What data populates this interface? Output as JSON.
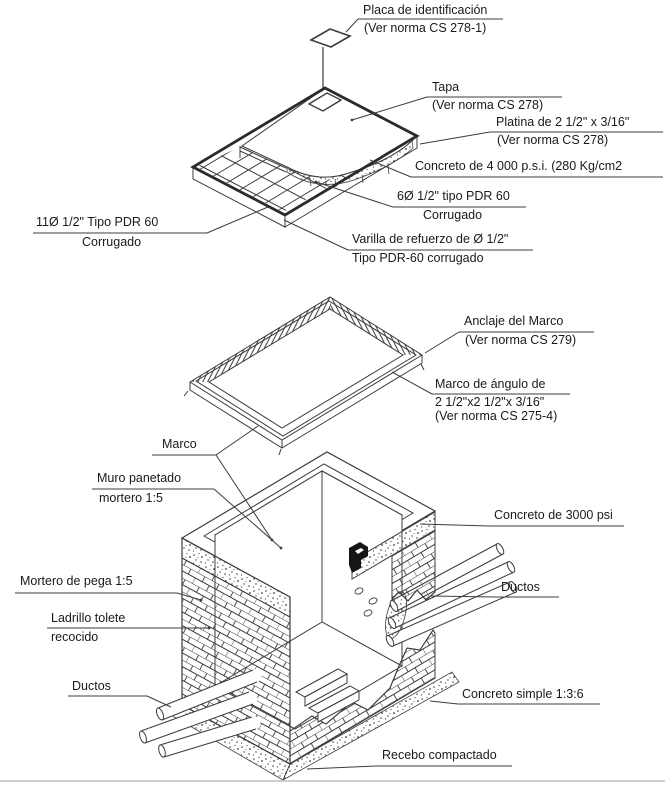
{
  "colors": {
    "line": "#3c3c3c",
    "thick_line": "#2b2b2b",
    "text": "#1a1a1a",
    "background": "#ffffff",
    "bottom_rule": "#c9d0d8"
  },
  "labels": {
    "placa": {
      "line1": "Placa de identificación",
      "line2": "(Ver norma CS 278-1)"
    },
    "tapa": {
      "line1": "Tapa",
      "line2": "(Ver norma CS 278)"
    },
    "platina": {
      "line1": "Platina de 2 1/2\" x 3/16\"",
      "line2": "(Ver norma CS 278)"
    },
    "concreto4000": {
      "line1": "Concreto de 4 000 p.s.i. (280 Kg/cm2"
    },
    "rebar6": {
      "line1": "6Ø 1/2\" tipo PDR 60",
      "line2": "Corrugado"
    },
    "rebar11": {
      "line1": "11Ø 1/2\" Tipo PDR 60",
      "line2": "Corrugado"
    },
    "varilla": {
      "line1": "Varilla de refuerzo de Ø 1/2\"",
      "line2": "Tipo  PDR-60 corrugado"
    },
    "anclaje": {
      "line1": "Anclaje del Marco",
      "line2": "(Ver norma CS 279)"
    },
    "marco_angulo": {
      "line1": "Marco de ángulo de",
      "line2": "2 1/2\"x2 1/2\"x 3/16\"",
      "line3": "(Ver norma CS 275-4)"
    },
    "marco": {
      "line1": "Marco"
    },
    "muro": {
      "line1": "Muro panetado",
      "line2": "mortero 1:5"
    },
    "concreto3000": {
      "line1": "Concreto de 3000 psi"
    },
    "mortero_pega": {
      "line1": "Mortero de pega 1:5"
    },
    "ladrillo": {
      "line1": "Ladrillo tolete",
      "line2": "recocido"
    },
    "ductos_left": {
      "line1": "Ductos"
    },
    "ductos_right": {
      "line1": "Ductos"
    },
    "concreto_simple": {
      "line1": "Concreto simple 1:3:6"
    },
    "recebo": {
      "line1": "Recebo compactado"
    }
  }
}
